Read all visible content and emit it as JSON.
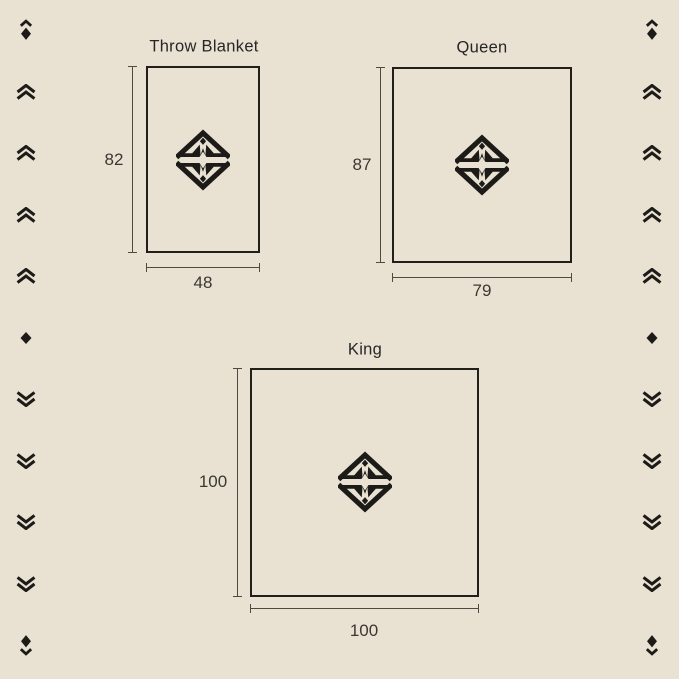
{
  "colors": {
    "background": "#e9e2d3",
    "ink": "#1c1b17",
    "dimension_line": "#4d4a42",
    "label_text": "#3a3831"
  },
  "figures": [
    {
      "title": "Throw Blanket",
      "height": "82",
      "width": "48"
    },
    {
      "title": "Queen",
      "height": "87",
      "width": "79"
    },
    {
      "title": "King",
      "height": "100",
      "width": "100"
    }
  ],
  "logo": {
    "name": "mountain-diamond-logo"
  },
  "side_icons": {
    "column": [
      "chevron-up-diamond",
      "double-chevron-up",
      "double-chevron-up",
      "double-chevron-up",
      "double-chevron-up",
      "diamond",
      "double-chevron-down",
      "double-chevron-down",
      "double-chevron-down",
      "double-chevron-down",
      "diamond-chevron-down"
    ]
  }
}
